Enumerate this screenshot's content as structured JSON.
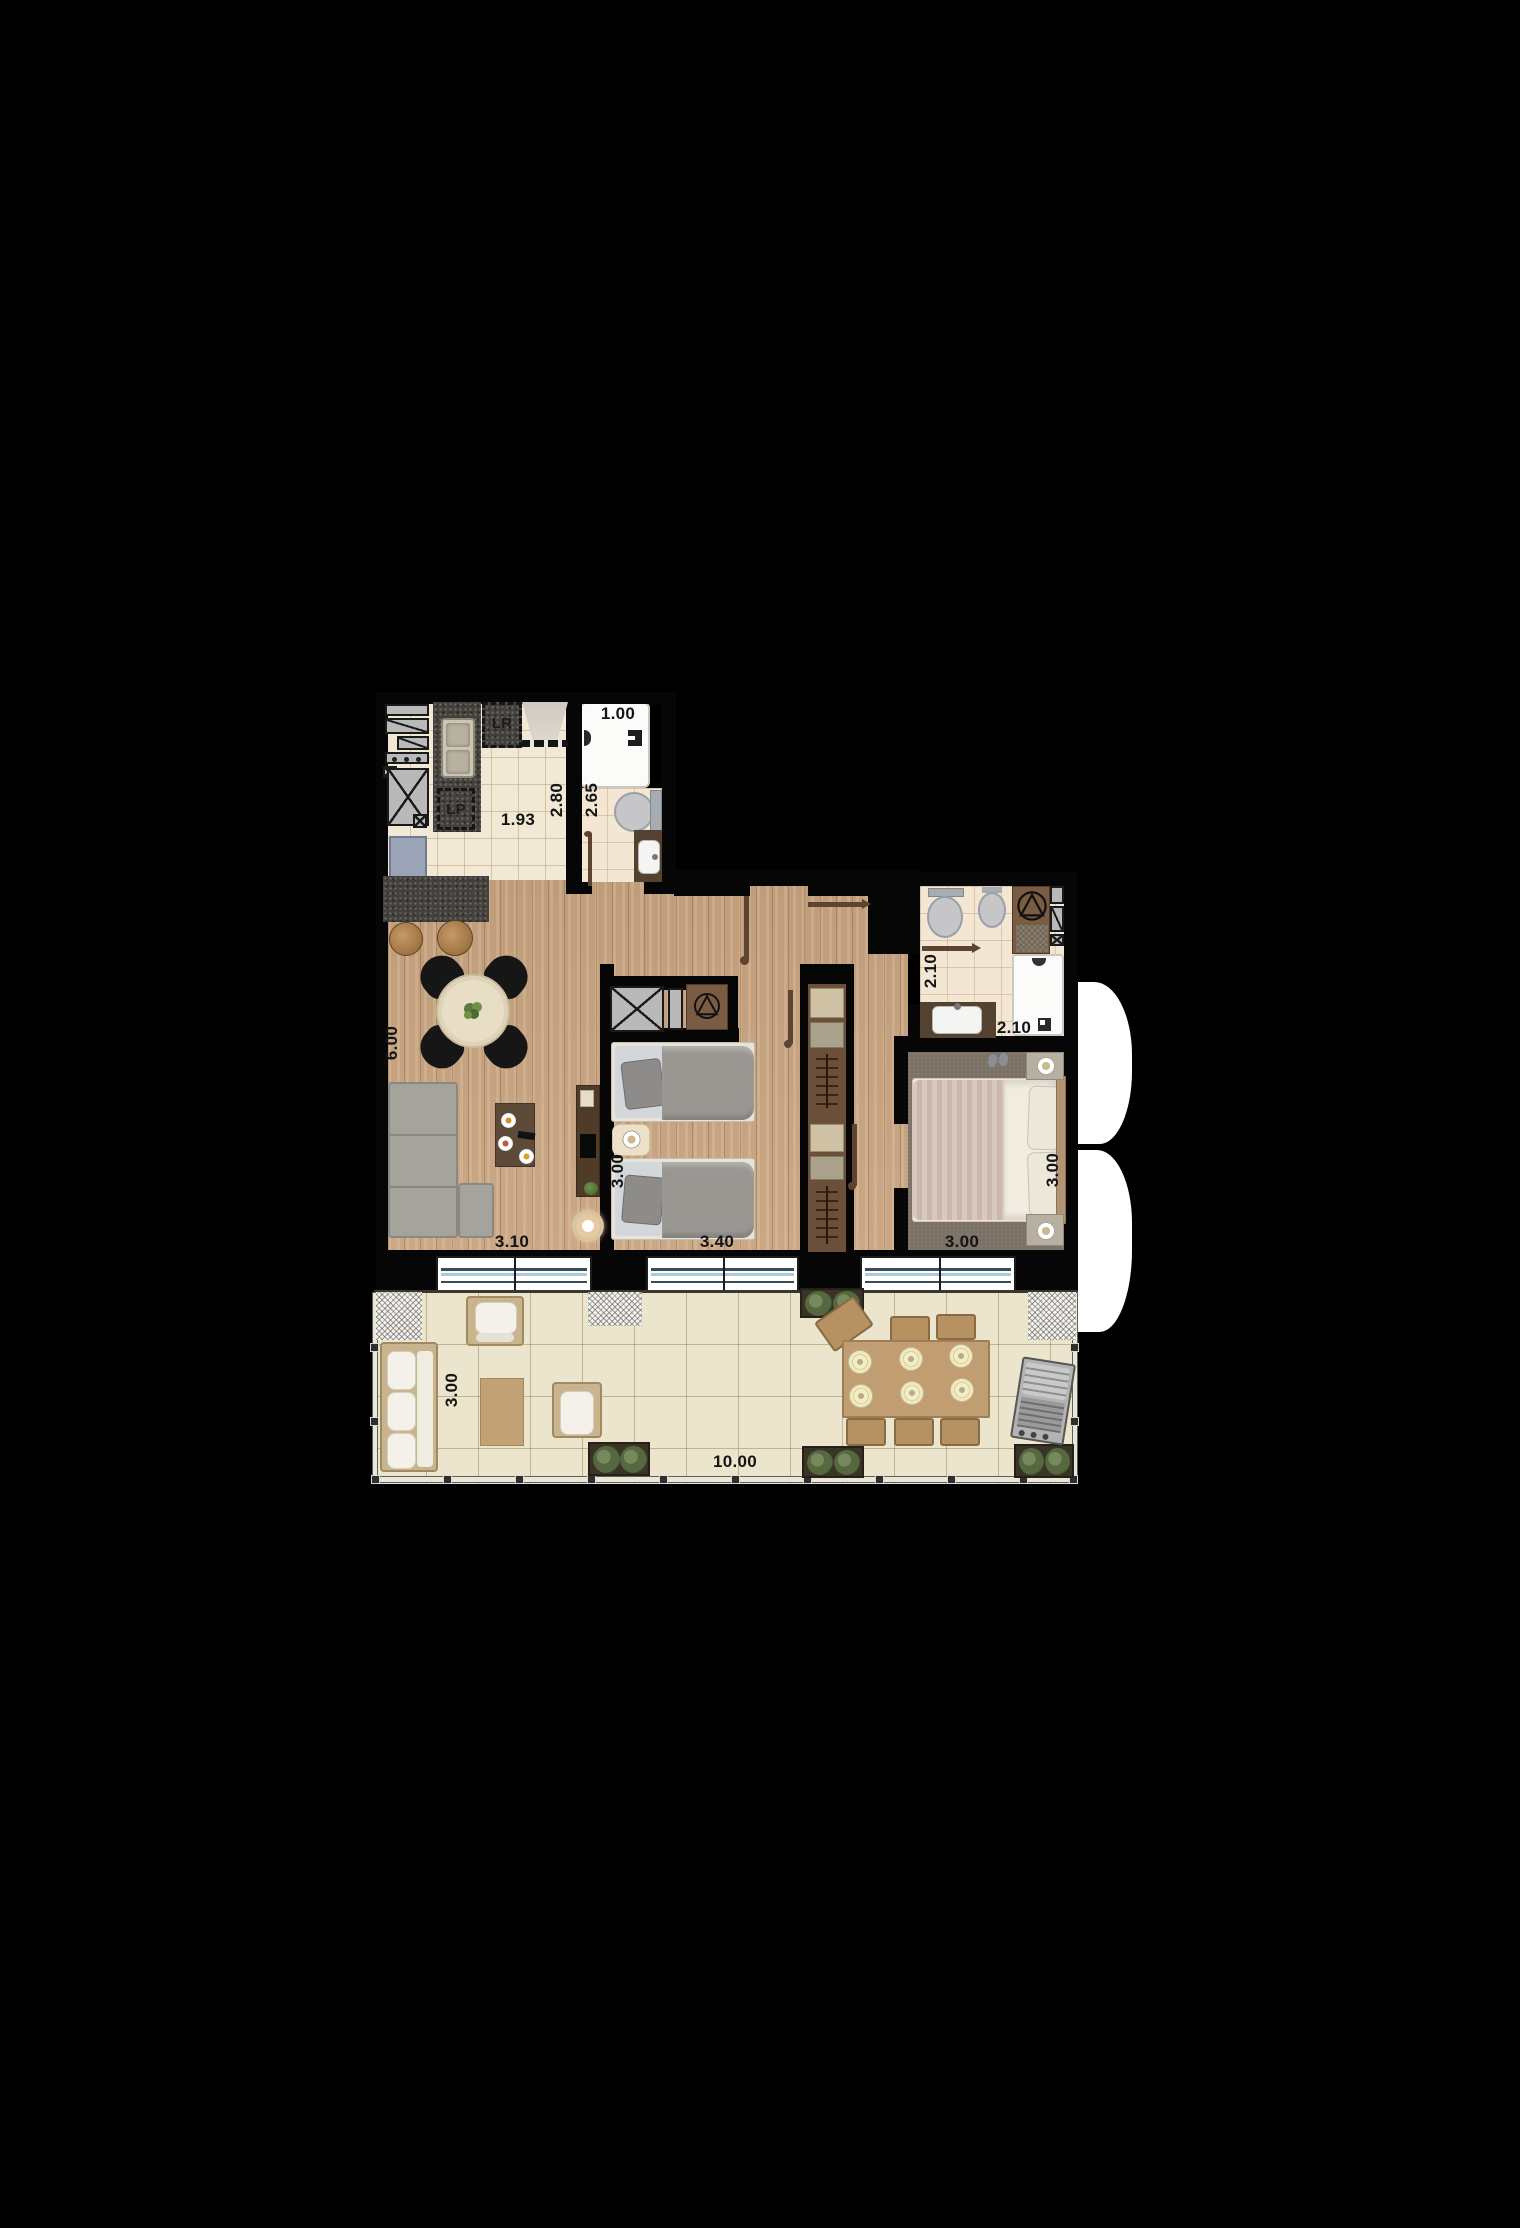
{
  "plan": {
    "labels": {
      "shower_box": "1.00",
      "service_corridor_length": "2.80",
      "service_bath_length": "2.65",
      "kitchen_width": "1.93",
      "washer_box": "LR",
      "dishwasher_box": "LP",
      "ensuite_length": "2.10",
      "ensuite_width": "2.10",
      "living_length": "6.00",
      "living_width": "3.10",
      "bedroom2_depth": "3.00",
      "bedroom2_width": "3.40",
      "master_depth": "3.00",
      "master_width": "3.00",
      "terrace_depth": "3.00",
      "terrace_width": "10.00"
    },
    "colors": {
      "background": "#000000",
      "wood_floor": "#c7a37f",
      "tile_floor": "#f1e9d5",
      "terrace_tile": "#ece5cd",
      "master_carpet": "#7b7166",
      "counter_granite": "#44413d",
      "window_glass": "#a7ccd8",
      "door_leaf": "#5c4430",
      "cabinet_gray": "#b9b9b9",
      "fixture_white": "#fbfbf9"
    }
  }
}
